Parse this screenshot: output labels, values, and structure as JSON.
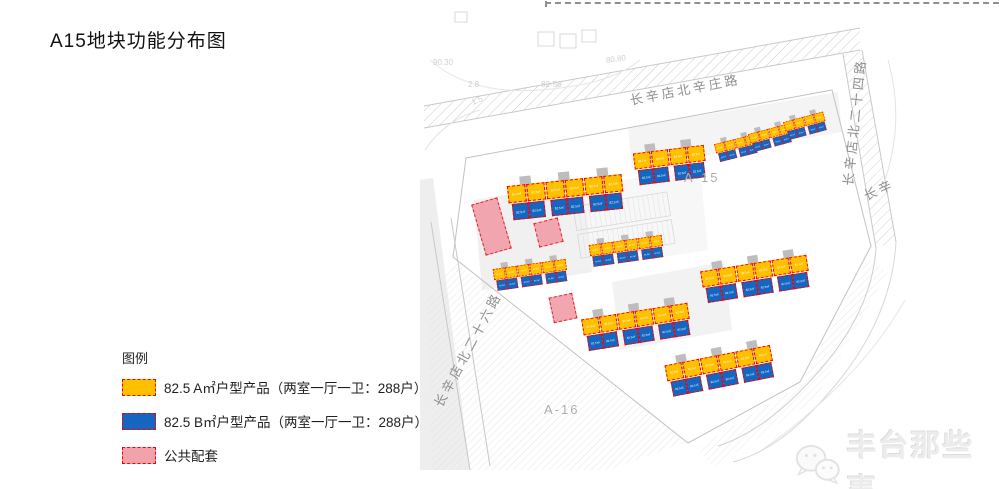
{
  "page": {
    "title": "A15地块功能分布图"
  },
  "legend": {
    "heading": "图例",
    "items": [
      {
        "name": "type-a-product",
        "color": "#ffc000",
        "label": "82.5 A㎡户型产品（两室一厅一卫：288户）"
      },
      {
        "name": "type-b-product",
        "color": "#1566c1",
        "label": "82.5 B㎡户型产品（两室一厅一卫：288户）"
      },
      {
        "name": "public-amenity",
        "color": "#f2a2ab",
        "label": "公共配套"
      }
    ],
    "swatch_border_color": "#f40000"
  },
  "map": {
    "unit_label": "82.5㎡",
    "unit_colors": {
      "type_a": "#ffc000",
      "type_b": "#1566c1",
      "core": "#bdbdbd",
      "dash": "#f50002"
    },
    "clusters": [
      {
        "x": 506,
        "y": 178,
        "rot": -6,
        "s": 3,
        "sc": 1.02
      },
      {
        "x": 632,
        "y": 146,
        "rot": -7,
        "s": 2,
        "sc": 0.95
      },
      {
        "x": 713,
        "y": 140,
        "rot": -14,
        "s": 2,
        "sc": 0.55
      },
      {
        "x": 747,
        "y": 130,
        "rot": -15,
        "s": 2,
        "sc": 0.55
      },
      {
        "x": 782,
        "y": 118,
        "rot": -15,
        "s": 2,
        "sc": 0.55
      },
      {
        "x": 588,
        "y": 240,
        "rot": -8,
        "s": 3,
        "sc": 0.65
      },
      {
        "x": 699,
        "y": 264,
        "rot": -9,
        "s": 3,
        "sc": 0.95
      },
      {
        "x": 492,
        "y": 264,
        "rot": -8,
        "s": 3,
        "sc": 0.65
      },
      {
        "x": 580,
        "y": 312,
        "rot": -9,
        "s": 3,
        "sc": 0.95
      },
      {
        "x": 663,
        "y": 358,
        "rot": -11,
        "s": 3,
        "sc": 0.95
      }
    ],
    "amenities": [
      {
        "x": 478,
        "y": 200,
        "w": 27,
        "h": 53,
        "rot": -16
      },
      {
        "x": 536,
        "y": 220,
        "w": 25,
        "h": 25,
        "rot": -14
      },
      {
        "x": 551,
        "y": 295,
        "w": 24,
        "h": 26,
        "rot": -12
      }
    ],
    "road_labels": [
      {
        "text": "长辛店北辛庄路",
        "x": 630,
        "y": 90,
        "rot": -11
      },
      {
        "text": "长辛店北二十四路",
        "x": 847,
        "y": 176,
        "rot": -84
      },
      {
        "text": "长辛店北二十六路",
        "x": 437,
        "y": 396,
        "rot": -62
      },
      {
        "text": "长辛",
        "x": 864,
        "y": 186,
        "rot": -24
      }
    ],
    "parcel_labels": [
      {
        "text": "A-15",
        "x": 684,
        "y": 170
      },
      {
        "text": "A-16",
        "x": 544,
        "y": 402
      }
    ],
    "marks": [
      {
        "text": "90.30",
        "x": 433,
        "y": 58,
        "rot": 0
      },
      {
        "text": "2.8",
        "x": 468,
        "y": 80,
        "rot": 0
      },
      {
        "text": "1.5",
        "x": 472,
        "y": 98,
        "rot": -22
      },
      {
        "text": "82-56",
        "x": 541,
        "y": 80,
        "rot": 0
      },
      {
        "text": "80.80",
        "x": 606,
        "y": 56,
        "rot": -8
      }
    ]
  },
  "watermark": {
    "text": "丰台那些事",
    "icon": "wechat-chat-bubbles-icon"
  }
}
